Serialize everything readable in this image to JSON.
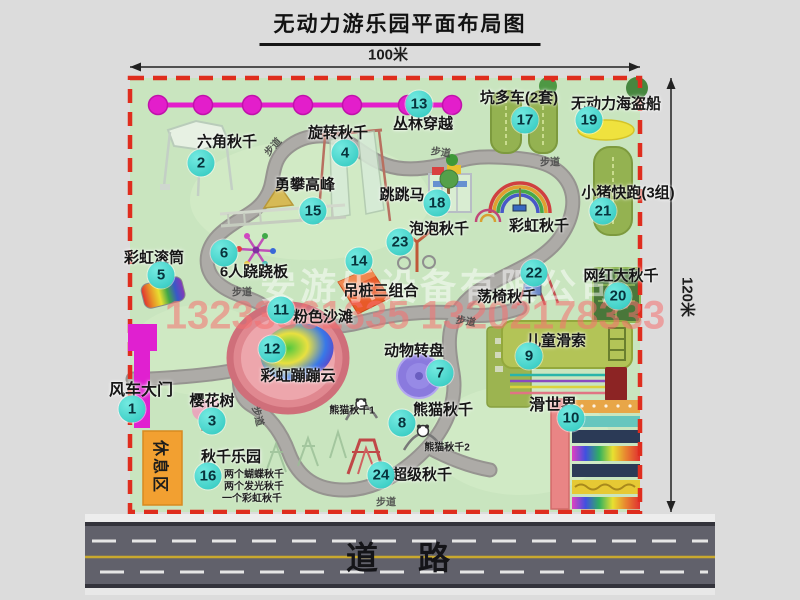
{
  "title": "无动力游乐园平面布局图",
  "dimensions": {
    "top": "100米",
    "right": "120米"
  },
  "road": {
    "label": "道　路"
  },
  "watermark": {
    "company": "安游乐设备有限公司",
    "phone": "13233861635 13202178333"
  },
  "rest_area": {
    "label": "休息区"
  },
  "colors": {
    "park_green": "#c9e5bf",
    "boundary_red": "#df2d1e",
    "path_gray": "#adaba7",
    "badge_teal": "#2cc6bd",
    "zipline_magenta": "#e31ecb",
    "gate_magenta": "#e020d0",
    "rest_orange": "#f2a031",
    "road_gray": "#61616b",
    "lane_yellow": "#c9a92e"
  },
  "attractions": [
    {
      "num": "1",
      "label": "风车大门",
      "lx": 141,
      "ly": 388,
      "bx": 132,
      "by": 409,
      "fs": 16
    },
    {
      "num": "2",
      "label": "六角秋千",
      "lx": 227,
      "ly": 141,
      "bx": 201,
      "by": 163
    },
    {
      "num": "3",
      "label": "樱花树",
      "lx": 212,
      "ly": 400,
      "bx": 212,
      "by": 421
    },
    {
      "num": "4",
      "label": "旋转秋千",
      "lx": 338,
      "ly": 132,
      "bx": 345,
      "by": 153
    },
    {
      "num": "5",
      "label": "彩虹滚筒",
      "lx": 154,
      "ly": 257,
      "bx": 161,
      "by": 275
    },
    {
      "num": "6",
      "label": "6人跷跷板",
      "lx": 254,
      "ly": 271,
      "bx": 224,
      "by": 253
    },
    {
      "num": "7",
      "label": "动物转盘",
      "lx": 414,
      "ly": 350,
      "bx": 440,
      "by": 373
    },
    {
      "num": "8",
      "label": "熊猫秋千",
      "lx": 443,
      "ly": 409,
      "bx": 402,
      "by": 423
    },
    {
      "num": "9",
      "label": "儿童滑索",
      "lx": 556,
      "ly": 340,
      "bx": 529,
      "by": 356
    },
    {
      "num": "10",
      "label": "滑世界",
      "lx": 553,
      "ly": 403,
      "bx": 571,
      "by": 418,
      "fs": 16
    },
    {
      "num": "11",
      "label": "粉色沙滩",
      "lx": 323,
      "ly": 316,
      "bx": 281,
      "by": 310
    },
    {
      "num": "12",
      "label": "彩虹蹦蹦云",
      "lx": 298,
      "ly": 375,
      "bx": 272,
      "by": 349
    },
    {
      "num": "13",
      "label": "丛林穿越",
      "lx": 423,
      "ly": 123,
      "bx": 419,
      "by": 104
    },
    {
      "num": "14",
      "label": "吊桩三组合",
      "lx": 381,
      "ly": 290,
      "bx": 359,
      "by": 261
    },
    {
      "num": "15",
      "label": "勇攀高峰",
      "lx": 305,
      "ly": 184,
      "bx": 313,
      "by": 211
    },
    {
      "num": "16",
      "label": "秋千乐园",
      "lx": 231,
      "ly": 456,
      "bx": 208,
      "by": 476
    },
    {
      "num": "17",
      "label": "坑多车(2套)",
      "lx": 519,
      "ly": 97,
      "bx": 525,
      "by": 120
    },
    {
      "num": "18",
      "label": "跳跳马",
      "lx": 402,
      "ly": 194,
      "bx": 437,
      "by": 203
    },
    {
      "num": "19",
      "label": "无动力海盗船",
      "lx": 616,
      "ly": 103,
      "bx": 589,
      "by": 120
    },
    {
      "num": "20",
      "label": "网红大秋千",
      "lx": 621,
      "ly": 275,
      "bx": 618,
      "by": 296
    },
    {
      "num": "21",
      "label": "小猪快跑(3组)",
      "lx": 628,
      "ly": 192,
      "bx": 603,
      "by": 211
    },
    {
      "num": "22",
      "label": "荡椅秋千",
      "lx": 507,
      "ly": 296,
      "bx": 534,
      "by": 273
    },
    {
      "num": "23",
      "label": "泡泡秋千",
      "lx": 439,
      "ly": 228,
      "bx": 400,
      "by": 242
    },
    {
      "num": "24",
      "label": "超级秋千",
      "lx": 422,
      "ly": 474,
      "bx": 381,
      "by": 475
    },
    {
      "num": "",
      "label": "彩虹秋千",
      "lx": 539,
      "ly": 225,
      "bx": 0,
      "by": 0
    }
  ],
  "sub_labels": [
    {
      "label": "熊猫秋千1",
      "x": 352,
      "y": 409
    },
    {
      "label": "熊猫秋千2",
      "x": 447,
      "y": 446
    },
    {
      "label": "两个蝴蝶秋千",
      "x": 254,
      "y": 473
    },
    {
      "label": "两个发光秋千",
      "x": 254,
      "y": 485
    },
    {
      "label": "一个彩虹秋千",
      "x": 252,
      "y": 497
    }
  ],
  "path_labels": [
    {
      "label": "步道",
      "x": 272,
      "y": 146,
      "rot": -48
    },
    {
      "label": "步道",
      "x": 441,
      "y": 151,
      "rot": 8
    },
    {
      "label": "步道",
      "x": 550,
      "y": 161,
      "rot": 0
    },
    {
      "label": "步道",
      "x": 242,
      "y": 291,
      "rot": 0
    },
    {
      "label": "步道",
      "x": 259,
      "y": 416,
      "rot": 75
    },
    {
      "label": "步道",
      "x": 466,
      "y": 320,
      "rot": 10
    },
    {
      "label": "步道",
      "x": 386,
      "y": 501,
      "rot": 0
    }
  ]
}
